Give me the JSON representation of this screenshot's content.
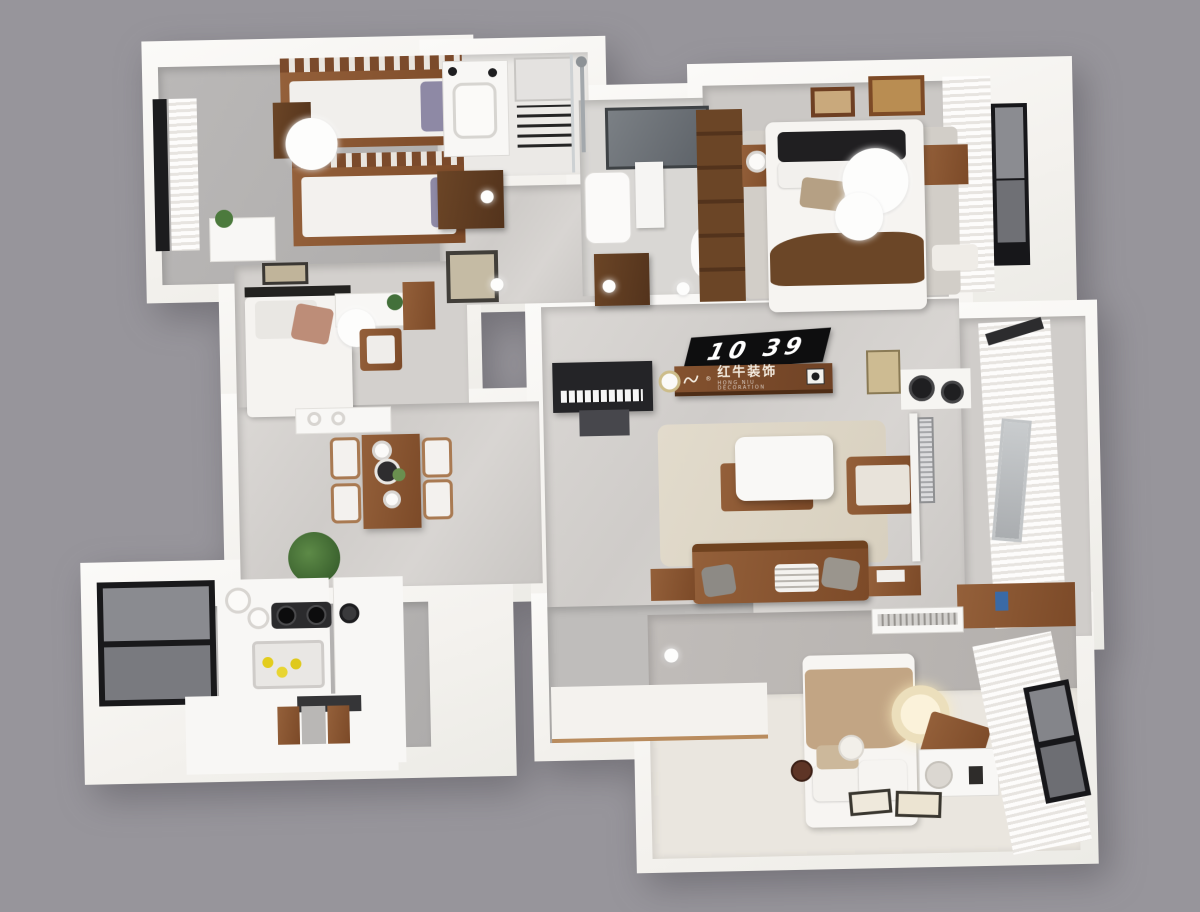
{
  "scene": {
    "description": "3D rendered top-down floor plan of a three-bedroom apartment",
    "tv_display": {
      "time": "10 39"
    },
    "brand_plaque": {
      "registered_mark": "®",
      "name": "红牛装饰",
      "subtext": "HONG NIU DECORATION"
    },
    "colors": {
      "background": "#97959b",
      "wall": "#f5f3f0",
      "floor_marble": "#d4d1ce",
      "floor_gray": "#b6b4b2",
      "wood": "#8a5531",
      "dark_wood": "#5e3a21",
      "rug": "#ded7c8",
      "tv_black": "#0e0e0f",
      "plaque_wood": "#7b4d2d",
      "blanket_brown": "#6b4627",
      "blanket_tan": "#c2a584"
    }
  }
}
